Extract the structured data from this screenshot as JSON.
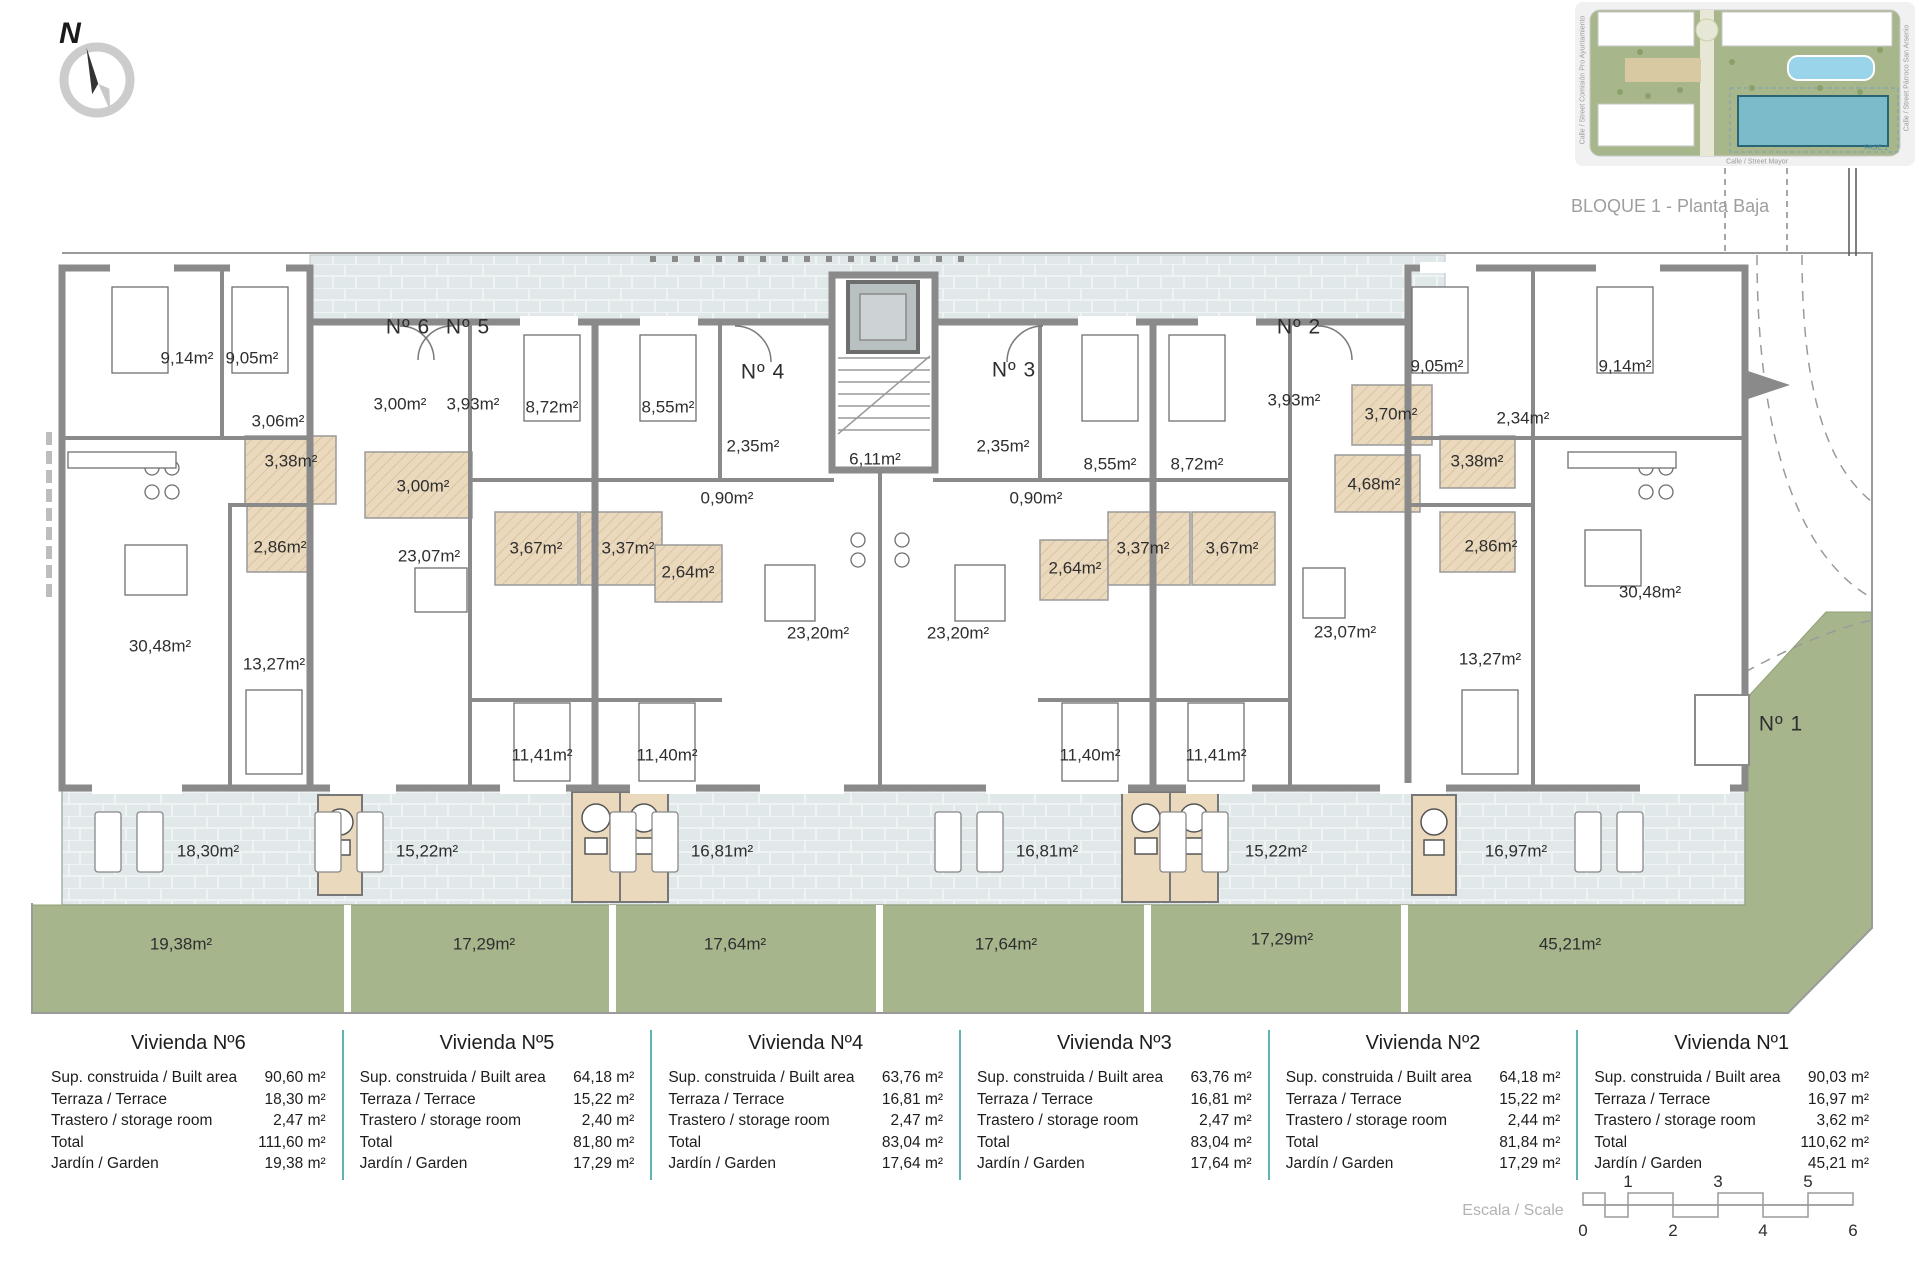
{
  "title": "BLOQUE 1 - Planta Baja",
  "compass": {
    "north": "N"
  },
  "site_inset": {
    "street_bottom": "Calle / Street  Mayor",
    "street_left": "Calle / Street  Comisión  Pro Ayuntamiento",
    "street_right": "Calle / Street  Párroco  San  Arsenio",
    "phase_label": "FASE 1"
  },
  "plan": {
    "entrances": {
      "e6": "Nº 6",
      "e5": "Nº 5",
      "e4": "Nº 4",
      "e3": "Nº 3",
      "e2": "Nº 2",
      "e1": "Nº 1"
    },
    "rooms": {
      "r1": "9,14m²",
      "r2": "9,05m²",
      "r3": "3,06m²",
      "r4": "3,38m²",
      "r5": "2,86m²",
      "r6": "30,48m²",
      "r7": "13,27m²",
      "r8": "3,00m²",
      "r9": "3,93m²",
      "r10": "3,00m²",
      "r11": "23,07m²",
      "r12": "8,72m²",
      "r13": "8,55m²",
      "r14": "3,67m²",
      "r15": "3,37m²",
      "r16": "11,41m²",
      "r17": "11,40m²",
      "r18": "2,35m²",
      "r19": "0,90m²",
      "r20": "2,64m²",
      "r21": "23,20m²",
      "r22": "6,11m²",
      "r23": "23,20m²",
      "r24": "2,35m²",
      "r25": "0,90m²",
      "r26": "2,64m²",
      "r27": "3,37m²",
      "r28": "3,67m²",
      "r29": "8,55m²",
      "r30": "8,72m²",
      "r31": "11,40m²",
      "r32": "11,41m²",
      "r33": "3,93m²",
      "r34": "3,70m²",
      "r35": "4,68m²",
      "r36": "23,07m²",
      "r37": "9,05m²",
      "r38": "9,14m²",
      "r39": "2,34m²",
      "r40": "3,38m²",
      "r41": "2,86m²",
      "r42": "30,48m²",
      "r43": "13,27m²"
    },
    "terraces": {
      "t1": "18,30m²",
      "t2": "15,22m²",
      "t3": "16,81m²",
      "t4": "16,81m²",
      "t5": "15,22m²",
      "t6": "16,97m²"
    },
    "gardens": {
      "g1": "19,38m²",
      "g2": "17,29m²",
      "g3": "17,64m²",
      "g4": "17,64m²",
      "g5": "17,29m²",
      "g6": "45,21m²"
    }
  },
  "table": {
    "row_labels": [
      "Sup. construida / Built area",
      "Terraza / Terrace",
      "Trastero / storage room",
      "Total",
      "Jardín / Garden"
    ],
    "units": [
      {
        "name": "Vivienda Nº6",
        "built": "90,60 m²",
        "terrace": "18,30 m²",
        "storage": "2,47 m²",
        "total": "111,60 m²",
        "garden": "19,38 m²"
      },
      {
        "name": "Vivienda Nº5",
        "built": "64,18 m²",
        "terrace": "15,22 m²",
        "storage": "2,40 m²",
        "total": "81,80 m²",
        "garden": "17,29 m²"
      },
      {
        "name": "Vivienda Nº4",
        "built": "63,76 m²",
        "terrace": "16,81 m²",
        "storage": "2,47 m²",
        "total": "83,04 m²",
        "garden": "17,64 m²"
      },
      {
        "name": "Vivienda Nº3",
        "built": "63,76 m²",
        "terrace": "16,81 m²",
        "storage": "2,47 m²",
        "total": "83,04 m²",
        "garden": "17,64 m²"
      },
      {
        "name": "Vivienda Nº2",
        "built": "64,18 m²",
        "terrace": "15,22 m²",
        "storage": "2,44 m²",
        "total": "81,84 m²",
        "garden": "17,29 m²"
      },
      {
        "name": "Vivienda Nº1",
        "built": "90,03 m²",
        "terrace": "16,97 m²",
        "storage": "3,62 m²",
        "total": "110,62 m²",
        "garden": "45,21 m²"
      }
    ]
  },
  "scale_bar": {
    "label": "Escala / Scale",
    "ticks_top": [
      "1",
      "3",
      "5"
    ],
    "ticks_bottom": [
      "0",
      "2",
      "4",
      "6"
    ]
  },
  "colors": {
    "wall_gray": "#8a8a8a",
    "terrace_paving": "#e1e8e9",
    "garden_green": "#a7b58c",
    "wet_room_beige": "#ead9bd",
    "table_separator_teal": "#5fb3b5",
    "highlight_building_teal": "#7cbcca"
  }
}
